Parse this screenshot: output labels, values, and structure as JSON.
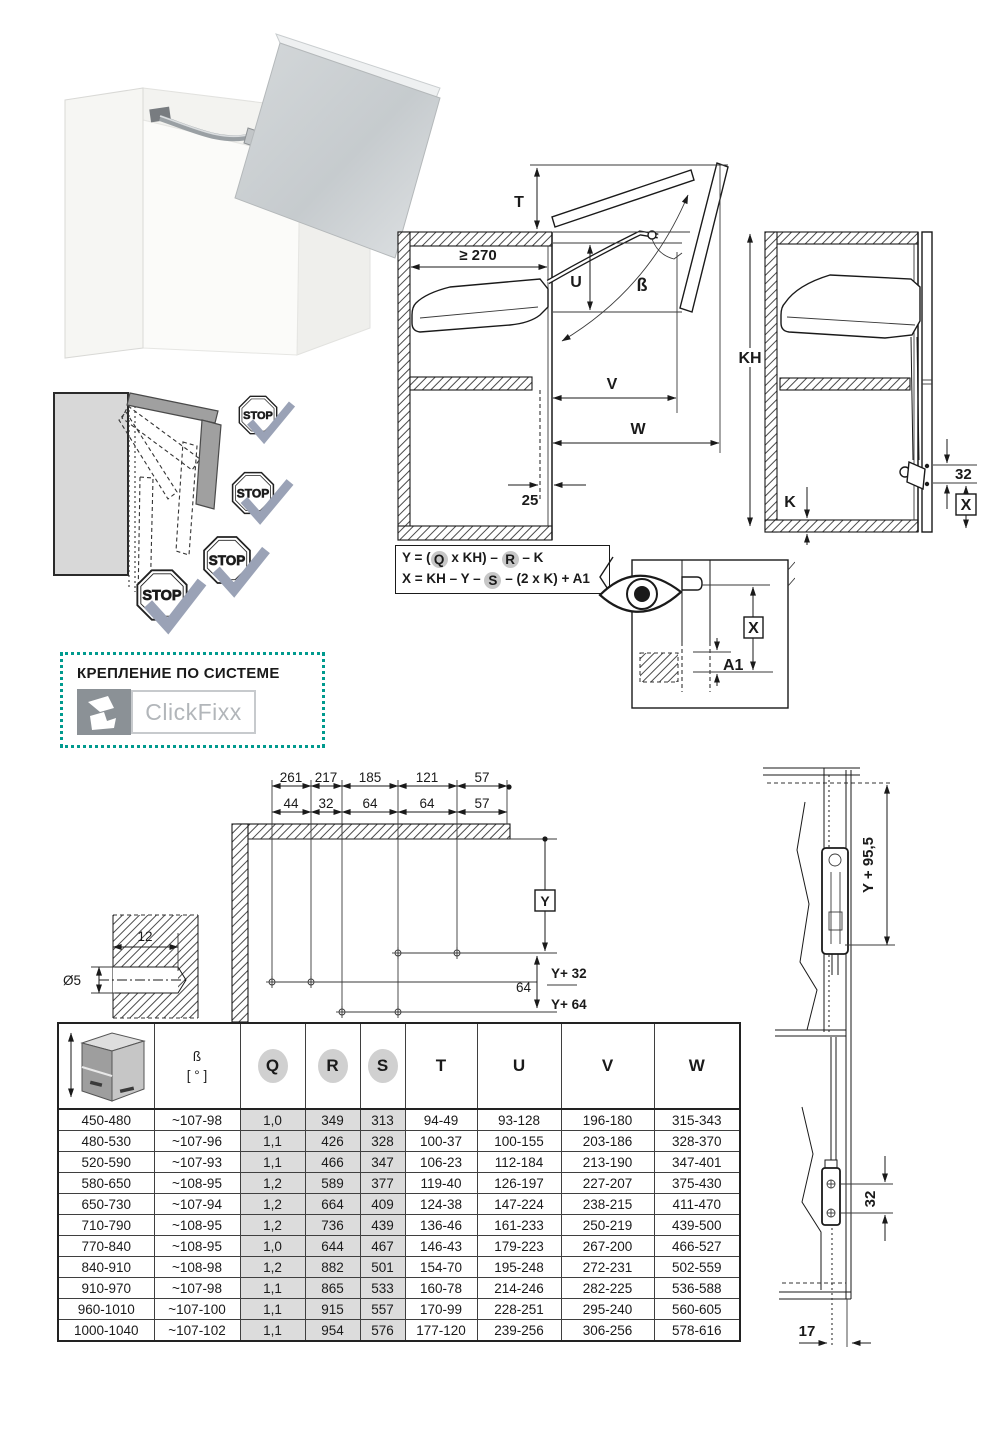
{
  "stops": {
    "label": "STOP"
  },
  "diag_open": {
    "t": "T",
    "min_depth": "≥ 270",
    "u": "U",
    "beta": "ß",
    "v": "V",
    "w": "W",
    "offset": "25"
  },
  "diag_closed": {
    "kh": "KH",
    "k": "K",
    "dim32": "32",
    "x": "X"
  },
  "formula": {
    "l1a": "Y = (",
    "l1b": "Q",
    "l1c": " x KH) – ",
    "l1d": "R",
    "l1e": " – K",
    "l2a": "X = KH – Y – ",
    "l2b": "S",
    "l2c": " – (2 x K) + A1"
  },
  "eye_detail": {
    "x": "X",
    "a1": "A1"
  },
  "clickfixx": {
    "title": "КРЕПЛЕНИЕ ПО СИСТЕМЕ",
    "brand": "ClickFixx",
    "accent": "#009a8e"
  },
  "drill": {
    "chain1": [
      "261",
      "217",
      "185",
      "121",
      "57"
    ],
    "chain2": [
      "44",
      "32",
      "64",
      "64",
      "57"
    ],
    "y": "Y",
    "y32": "Y+ 32",
    "y64": "Y+ 64",
    "span64": "64"
  },
  "hole": {
    "depth": "12",
    "dia": "Ø5"
  },
  "side_section": {
    "ydim": "Y + 95,5",
    "holes": "32",
    "front": "17"
  },
  "table": {
    "headers": {
      "beta": "ß",
      "beta_unit": "[ ° ]",
      "q": "Q",
      "r": "R",
      "s": "S",
      "t": "T",
      "u": "U",
      "v": "V",
      "w": "W"
    },
    "rows": [
      [
        "450-480",
        "~107-98",
        "1,0",
        "349",
        "313",
        "94-49",
        "93-128",
        "196-180",
        "315-343"
      ],
      [
        "480-530",
        "~107-96",
        "1,1",
        "426",
        "328",
        "100-37",
        "100-155",
        "203-186",
        "328-370"
      ],
      [
        "520-590",
        "~107-93",
        "1,1",
        "466",
        "347",
        "106-23",
        "112-184",
        "213-190",
        "347-401"
      ],
      [
        "580-650",
        "~108-95",
        "1,2",
        "589",
        "377",
        "119-40",
        "126-197",
        "227-207",
        "375-430"
      ],
      [
        "650-730",
        "~107-94",
        "1,2",
        "664",
        "409",
        "124-38",
        "147-224",
        "238-215",
        "411-470"
      ],
      [
        "710-790",
        "~108-95",
        "1,2",
        "736",
        "439",
        "136-46",
        "161-233",
        "250-219",
        "439-500"
      ],
      [
        "770-840",
        "~108-95",
        "1,0",
        "644",
        "467",
        "146-43",
        "179-223",
        "267-200",
        "466-527"
      ],
      [
        "840-910",
        "~108-98",
        "1,2",
        "882",
        "501",
        "154-70",
        "195-248",
        "272-231",
        "502-559"
      ],
      [
        "910-970",
        "~107-98",
        "1,1",
        "865",
        "533",
        "160-78",
        "214-246",
        "282-225",
        "536-588"
      ],
      [
        "960-1010",
        "~107-100",
        "1,1",
        "915",
        "557",
        "170-99",
        "228-251",
        "295-240",
        "560-605"
      ],
      [
        "1000-1040",
        "~107-102",
        "1,1",
        "954",
        "576",
        "177-120",
        "239-256",
        "306-256",
        "578-616"
      ]
    ]
  }
}
